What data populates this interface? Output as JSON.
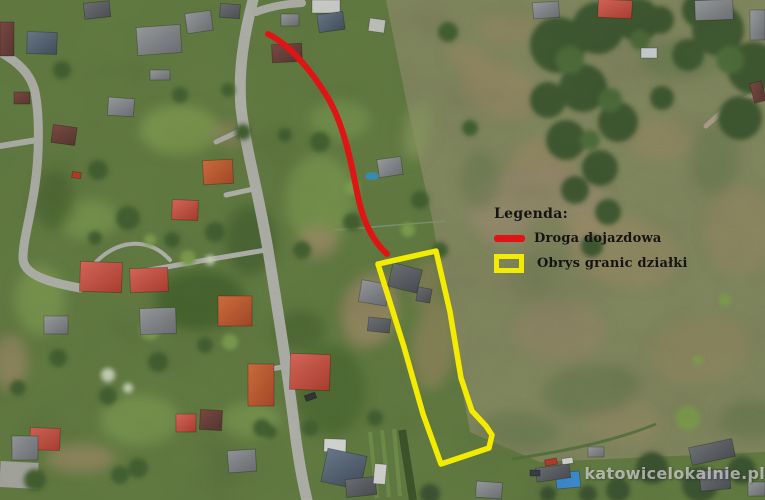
{
  "legend": {
    "heading": "Legenda:",
    "items": [
      {
        "label": "Droga dojazdowa",
        "symbol": "red-line"
      },
      {
        "label": "Obrys granic działki",
        "symbol": "yellow-rectangle-outline"
      }
    ]
  },
  "watermark": {
    "text": "katowicelokalnie.pl"
  },
  "colors": {
    "access_road_line": "#e01414",
    "plot_boundary": "#f4ec00",
    "legend_text": "#161412",
    "watermark_text": "rgba(235,235,235,0.62)"
  }
}
